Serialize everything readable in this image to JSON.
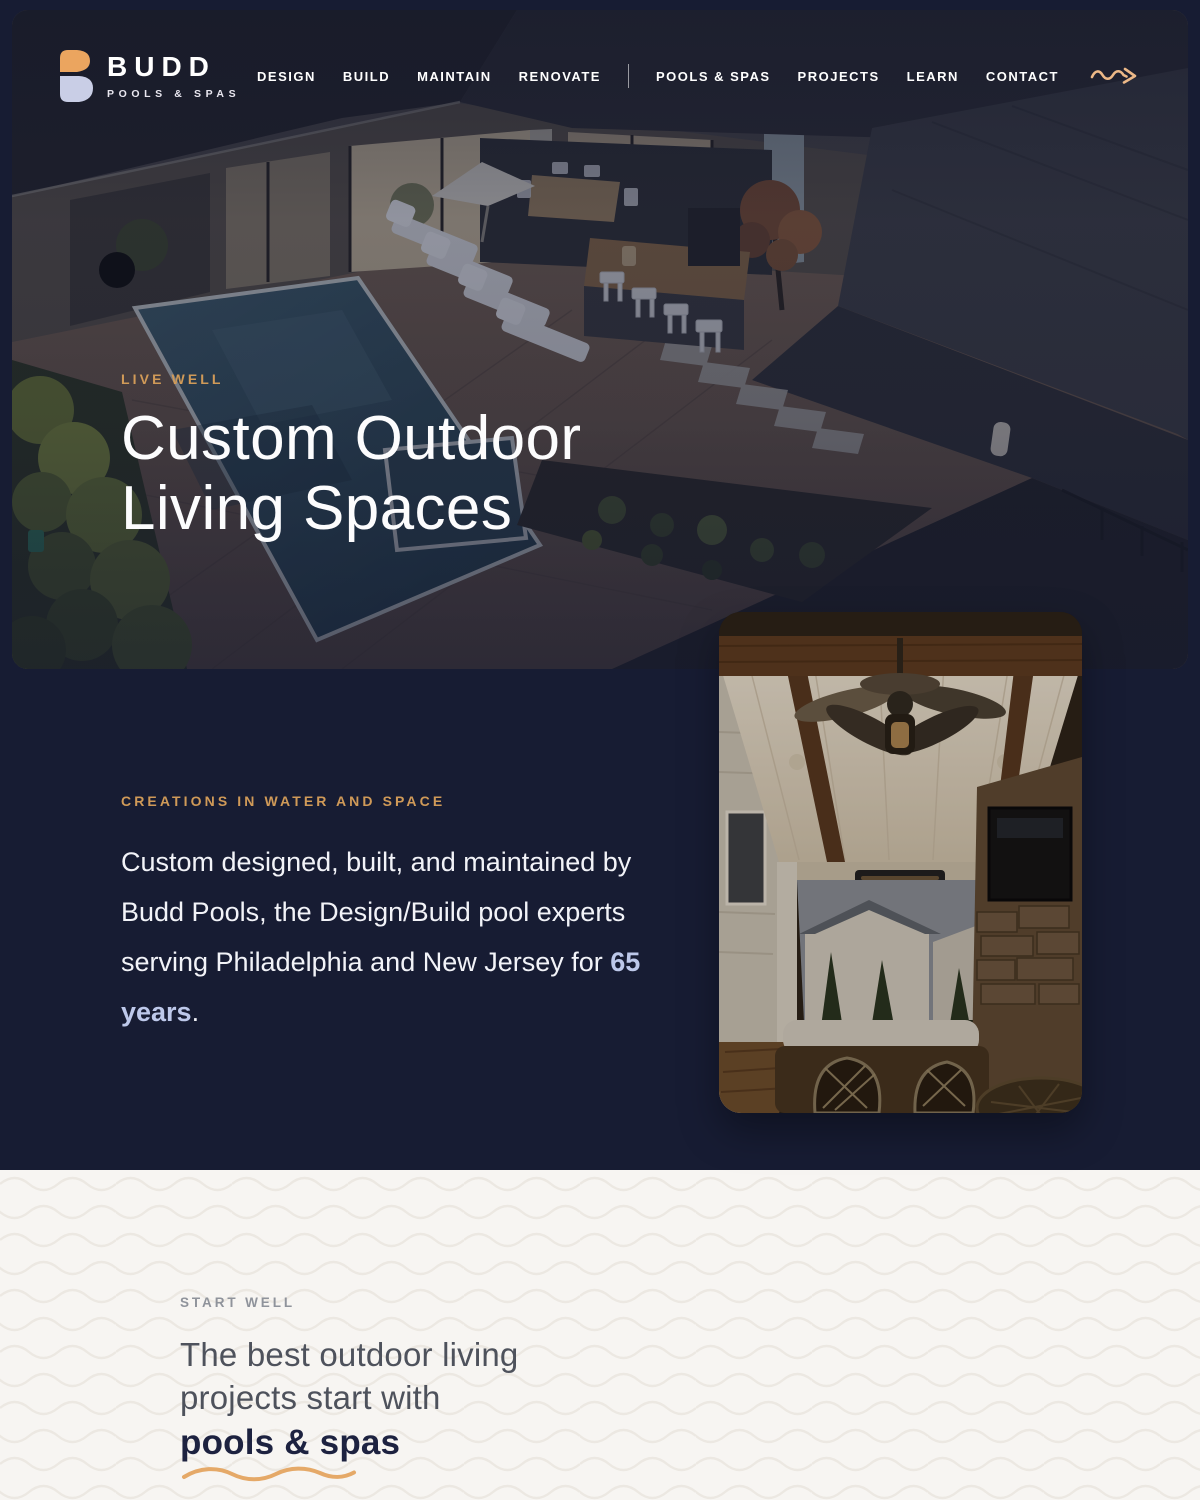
{
  "brand": {
    "name": "BUDD",
    "tagline": "POOLS & SPAS"
  },
  "nav": {
    "primary": [
      {
        "label": "DESIGN"
      },
      {
        "label": "BUILD"
      },
      {
        "label": "MAINTAIN"
      },
      {
        "label": "RENOVATE"
      }
    ],
    "secondary": [
      {
        "label": "POOLS & SPAS"
      },
      {
        "label": "PROJECTS"
      },
      {
        "label": "LEARN"
      },
      {
        "label": "CONTACT"
      }
    ],
    "arrow_icon": "squiggle-arrow-right"
  },
  "hero": {
    "eyebrow": "LIVE WELL",
    "title_line1": "Custom Outdoor",
    "title_line2": "Living Spaces",
    "image_alt": "aerial dusk view of modern home with pool, lounge chairs and outdoor kitchen"
  },
  "about": {
    "eyebrow": "CREATIONS IN WATER AND SPACE",
    "text_before": "Custom designed, built, and maintained by Budd Pools, the Design/Build pool experts serving Philadelphia and New Jersey for ",
    "highlight": "65 years",
    "text_after": ".",
    "image_alt": "covered patio with wood beams, ceiling fan, stone fireplace and TV"
  },
  "start": {
    "eyebrow": "START WELL",
    "title_line1": "The best outdoor living",
    "title_line2": "projects start with",
    "highlight": "pools & spas"
  },
  "colors": {
    "navy": "#171c33",
    "accent_orange": "#d09a58",
    "accent_light": "#ecb887",
    "logo_orange": "#eba55f",
    "logo_lavender": "#c9cee6",
    "highlight_periwinkle": "#bdc8ea",
    "cream": "#f7f5f2",
    "heading_slate": "#4e525c",
    "heading_navy": "#1d2240"
  }
}
